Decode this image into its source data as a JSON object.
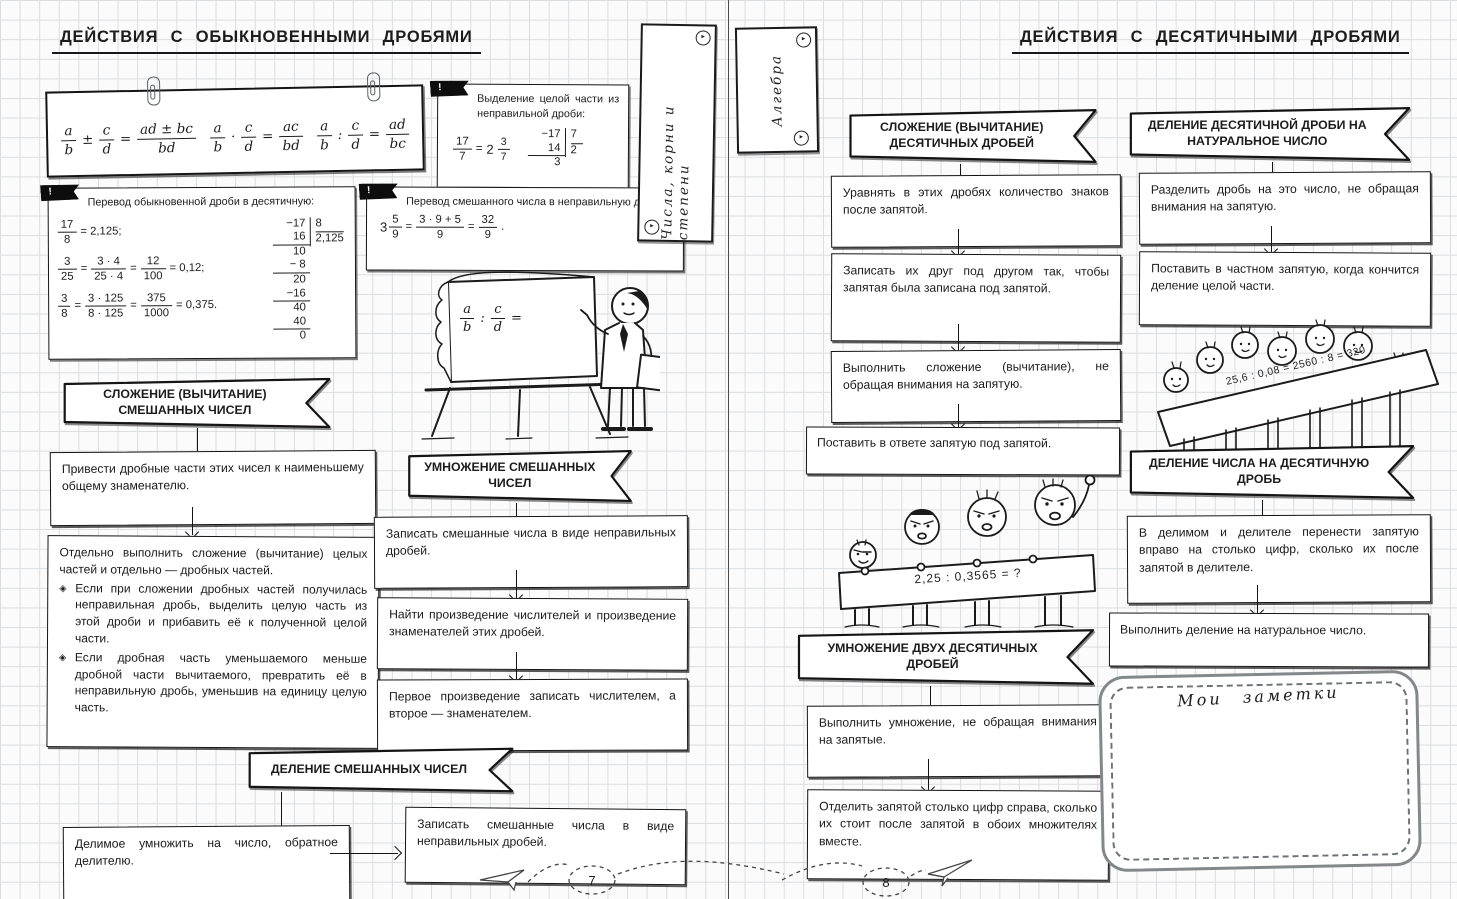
{
  "symbols": {
    "eq": "=",
    "bang": "!",
    "bullet": "◈",
    "period": ".",
    "tab_arrow": "▸"
  },
  "left_page": {
    "title": "ДЕЙСТВИЯ  С  ОБЫКНОВЕННЫМИ  ДРОБЯМИ",
    "page_number": "7",
    "formula_card": {
      "add": {
        "n1": "a",
        "d1": "b",
        "op": "±",
        "n2": "c",
        "d2": "d",
        "rn": "ad ± bc",
        "rd": "bd"
      },
      "mul": {
        "n1": "a",
        "d1": "b",
        "op": "·",
        "n2": "c",
        "d2": "d",
        "rn": "ac",
        "rd": "bd"
      },
      "div": {
        "n1": "a",
        "d1": "b",
        "op": ":",
        "n2": "c",
        "d2": "d",
        "rn": "ad",
        "rd": "bc"
      }
    },
    "extract_box": {
      "title": "Выделение целой части из неправильной дроби:",
      "ex": {
        "n": "17",
        "d": "7",
        "whole": "2",
        "mn": "3",
        "md": "7"
      },
      "div": {
        "l1": "−17",
        "l2": "14",
        "rem": "3",
        "divisor": "7",
        "quot": "2"
      }
    },
    "dec_box": {
      "title": "Перевод обыкновенной дроби в десятичную:",
      "r1": {
        "n": "17",
        "d": "8",
        "res": "= 2,125;"
      },
      "r2": {
        "n1": "3",
        "d1": "25",
        "n2": "3 · 4",
        "d2": "25 · 4",
        "n3": "12",
        "d3": "100",
        "res": "= 0,12;"
      },
      "r3": {
        "n1": "3",
        "d1": "8",
        "n2": "3 · 125",
        "d2": "8 · 125",
        "n3": "375",
        "d3": "1000",
        "res": "= 0,375."
      },
      "div": {
        "divisor": "8",
        "quot": "2,125",
        "lines": [
          "−17",
          "16",
          "10",
          "− 8",
          "20",
          "−16",
          "40",
          "40",
          "0"
        ]
      }
    },
    "improper_box": {
      "title": "Перевод смешанного числа в неправильную дробь:",
      "whole": "3",
      "n1": "5",
      "d1": "9",
      "n2": "3 · 9 + 5",
      "d2": "9",
      "n3": "32",
      "d3": "9"
    },
    "board": {
      "n1": "a",
      "d1": "b",
      "op": ":",
      "n2": "c",
      "d2": "d"
    },
    "flow_add": {
      "flag": "СЛОЖЕНИЕ (ВЫЧИТАНИЕ) СМЕШАННЫХ ЧИСЕЛ",
      "step1": "Привести дробные части этих чисел к наименьшему общему знаменателю.",
      "step2": "Отдельно выполнить сложение (вычитание) целых частей и отдельно — дробных частей.",
      "b1": "Если при сложении дробных частей получилась неправильная дробь, выделить целую часть из этой дроби и прибавить её к полученной целой части.",
      "b2": "Если дробная часть уменьшаемого меньше дробной части вычитаемого, превратить её в неправильную дробь, уменьшив на единицу целую часть."
    },
    "flow_mul": {
      "flag": "УМНОЖЕНИЕ СМЕШАННЫХ ЧИСЕЛ",
      "step1": "Записать смешанные числа в виде неправильных дробей.",
      "step2": "Найти произведение числителей и произведение знаменателей этих дробей.",
      "step3": "Первое произведение записать числителем, а второе — знаменателем."
    },
    "flow_div": {
      "flag": "ДЕЛЕНИЕ  СМЕШАННЫХ  ЧИСЕЛ",
      "step1": "Делимое умножить на число, обратное делителю.",
      "step2": "Записать смешанные числа в виде неправильных дробей."
    }
  },
  "spine": {
    "tab_left": "Числа,  корни  и  степени",
    "tab_right": "Алгебра"
  },
  "right_page": {
    "title": "ДЕЙСТВИЯ  С  ДЕСЯТИЧНЫМИ  ДРОБЯМИ",
    "page_number": "8",
    "flow_addsub": {
      "flag": "СЛОЖЕНИЕ (ВЫЧИТАНИЕ) ДЕСЯТИЧНЫХ ДРОБЕЙ",
      "step1": "Уравнять в этих дробях количество знаков после запятой.",
      "step2": "Записать их друг под другом так, чтобы запятая была записана под запятой.",
      "step3": "Выполнить сложение (вычитание), не обращая внимания на запятую.",
      "step4": "Поставить в ответе запятую под запятой."
    },
    "flow_divnat": {
      "flag": "ДЕЛЕНИЕ ДЕСЯТИЧНОЙ ДРОБИ НА НАТУРАЛЬНОЕ ЧИСЛО",
      "step1": "Разделить дробь на это число, не обращая внимания на запятую.",
      "step2": "Поставить в частном запятую, когда кончится деление целой части."
    },
    "banner_example": "25,6  :  0,08  =  2560  :  8  =  320",
    "flow_divdec": {
      "flag": "ДЕЛЕНИЕ ЧИСЛА НА ДЕСЯТИЧНУЮ ДРОБЬ",
      "step1": "В делимом и делителе перенести запятую вправо на столько цифр, сколько их после запятой в делителе.",
      "step2": "Выполнить деление на натуральное число."
    },
    "protest_banner": "2,25  :  0,3565  =  ?",
    "flow_muldec": {
      "flag": "УМНОЖЕНИЕ ДВУХ ДЕСЯТИЧНЫХ ДРОБЕЙ",
      "step1": "Выполнить умножение, не обращая внимания на запятые.",
      "step2": "Отделить запятой столько цифр справа, сколько их стоит после запятой в обоих множителях вместе."
    },
    "notes_title": "Мои  заметки"
  }
}
